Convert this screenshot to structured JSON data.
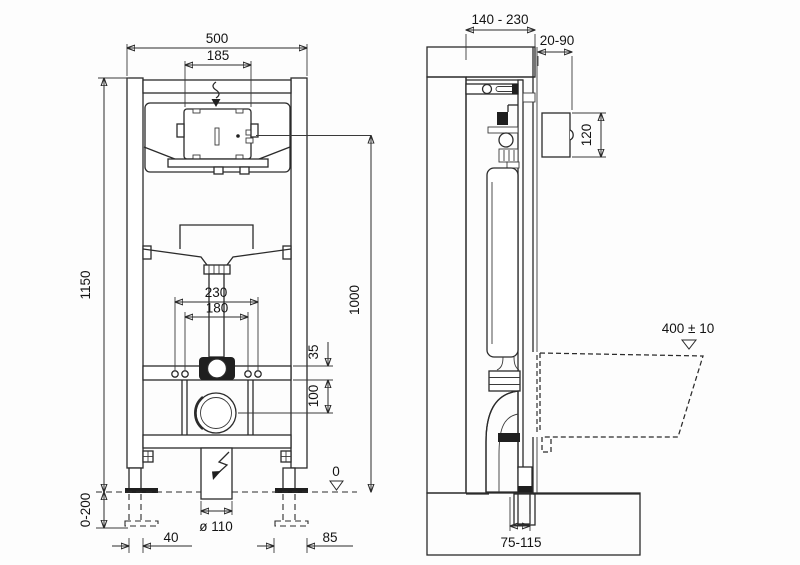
{
  "drawing": {
    "front_view": {
      "width_overall": "500",
      "plate_opening_width": "185",
      "frame_height": "1150",
      "flush_bend_height": "1000",
      "fixing_bolts_outer": "230",
      "fixing_bolts_inner": "180",
      "flush_offset": "35",
      "outlet_offset": "100",
      "foot_adjust_range": "0-200",
      "foot_left_width": "40",
      "drain_diameter": "ø 110",
      "foot_right_width": "85",
      "floor_level": "0"
    },
    "side_view": {
      "frame_depth_range": "140 - 230",
      "wall_finish_range": "20-90",
      "plate_height": "120",
      "bowl_height": "400 ± 10",
      "outlet_distance": "75-115"
    }
  }
}
